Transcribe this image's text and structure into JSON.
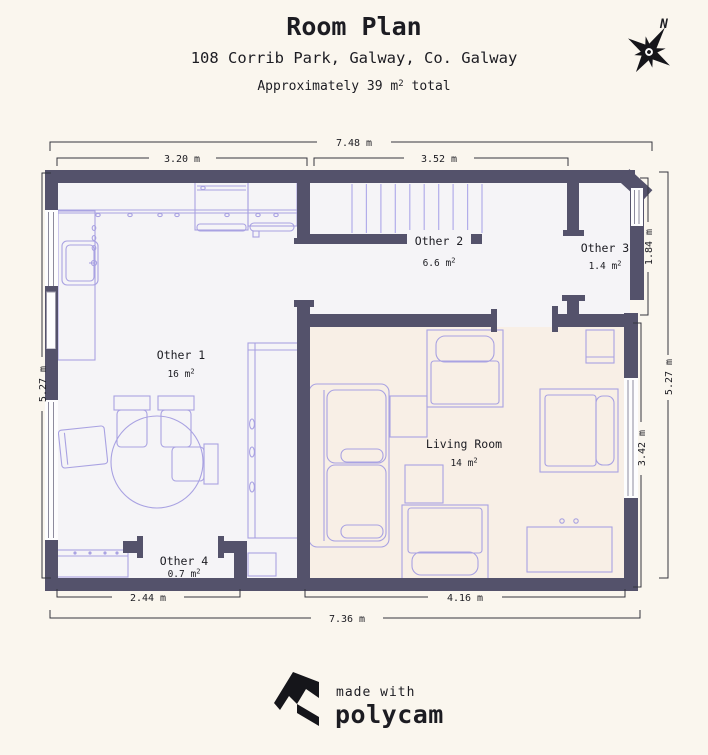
{
  "header": {
    "title": "Room Plan",
    "address": "108 Corrib Park, Galway, Co. Galway",
    "area_note": {
      "prefix": "Approximately 39 m",
      "sup": "2",
      "suffix": " total"
    },
    "compass": "N"
  },
  "rooms": [
    {
      "name": "Other 1",
      "area": "16 m",
      "sup": "2"
    },
    {
      "name": "Other 2",
      "area": "6.6 m",
      "sup": "2"
    },
    {
      "name": "Other 3",
      "area": "1.4 m",
      "sup": "2"
    },
    {
      "name": "Living Room",
      "area": "14 m",
      "sup": "2"
    },
    {
      "name": "Other 4",
      "area": "0.7 m",
      "sup": "2"
    }
  ],
  "dimensions": {
    "top_total": "7.48 m",
    "top_left": "3.20 m",
    "top_right": "3.52 m",
    "left_side": "5.27 m",
    "right_side": "5.27 m",
    "other3_depth": "1.84 m",
    "living_depth": "3.42 m",
    "bottom_left": "2.44 m",
    "bottom_right": "4.16 m",
    "bottom_total": "7.36 m"
  },
  "footer": {
    "tagline": "made with",
    "brand": "polycam"
  },
  "colors": {
    "background": "#faf6ee",
    "floor": "#f5f4f7",
    "living_floor": "#f8efe6",
    "wall": "#54526b",
    "furniture": "#a9a2e2",
    "stairs": "#b2adea",
    "ink": "#1c1c22",
    "dim_line": "#35353f"
  }
}
